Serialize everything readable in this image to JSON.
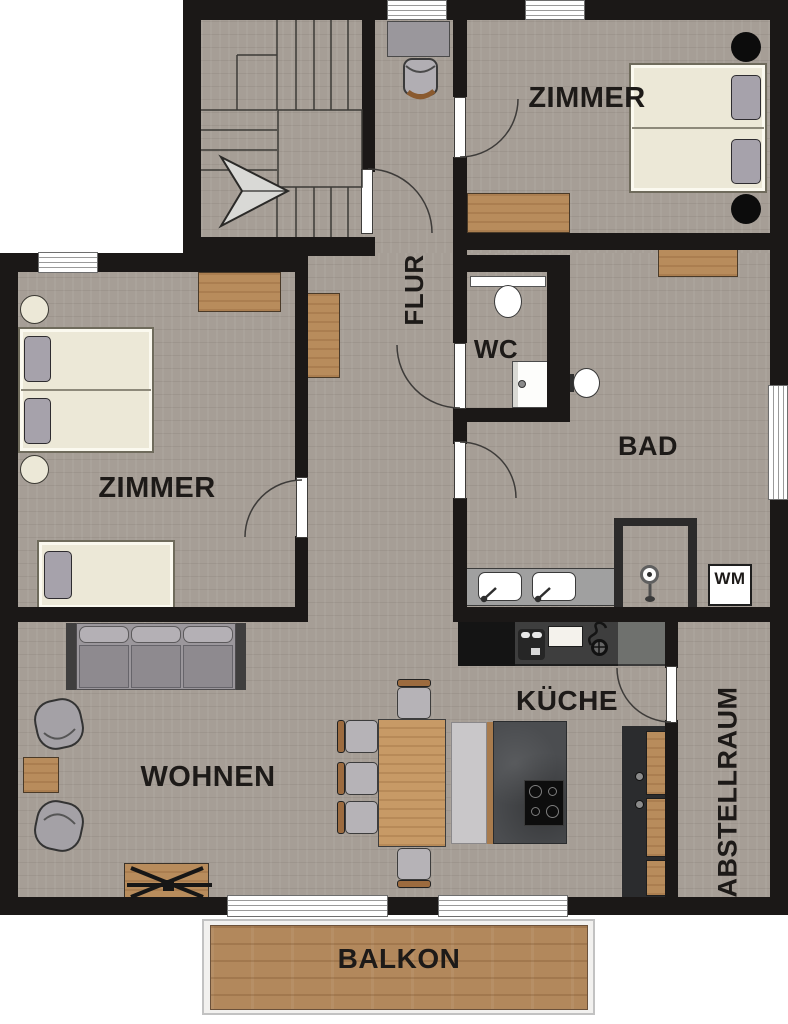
{
  "title": "apartment-floorplan",
  "rooms": {
    "flur": "FLUR",
    "zimmer_top": "ZIMMER",
    "zimmer_left": "ZIMMER",
    "wc": "WC",
    "bad": "BAD",
    "wohnen": "WOHNEN",
    "kueche": "KÜCHE",
    "abstellraum": "ABSTELLRAUM",
    "balkon": "BALKON"
  },
  "appliances": {
    "washing_machine": "WM"
  },
  "furniture": [
    "staircase-with-direction-arrow",
    "desk-with-office-chair",
    "double-bed-top-room",
    "double-bed-left-room",
    "single-bed",
    "nightstands",
    "dressers",
    "hall-cabinet",
    "toilet-wc",
    "hand-basin",
    "wall-hung-toilet-bad",
    "double-vanity",
    "shower",
    "washing-machine",
    "sofa",
    "two-armchairs",
    "side-table",
    "folding-table",
    "dining-table",
    "five-chairs",
    "bench",
    "kitchen-island-with-cooktop",
    "kitchen-counter-with-sink",
    "tall-cabinet",
    "balcony-deck"
  ],
  "colors": {
    "wall": "#1b1817",
    "floor": "#a69e96",
    "wood": "#b88c5c",
    "deck": "#b2885c",
    "mattress": "#ece8d7",
    "pillow": "#a6a2ab",
    "sofa": "#9b979c",
    "sofa-dark": "#8e8a8f",
    "armrest": "#3f3e3e",
    "rug": "#9a979c",
    "counter-dark": "#3e3e3e",
    "counter-gray": "#6f716e",
    "island": "#4b4d50",
    "bench": "#c9c7c9",
    "cabinet": "#2b2c2e",
    "vanity": "#a0a0a0",
    "text": "#1d1a18",
    "winframe": "#6e6e6e"
  }
}
